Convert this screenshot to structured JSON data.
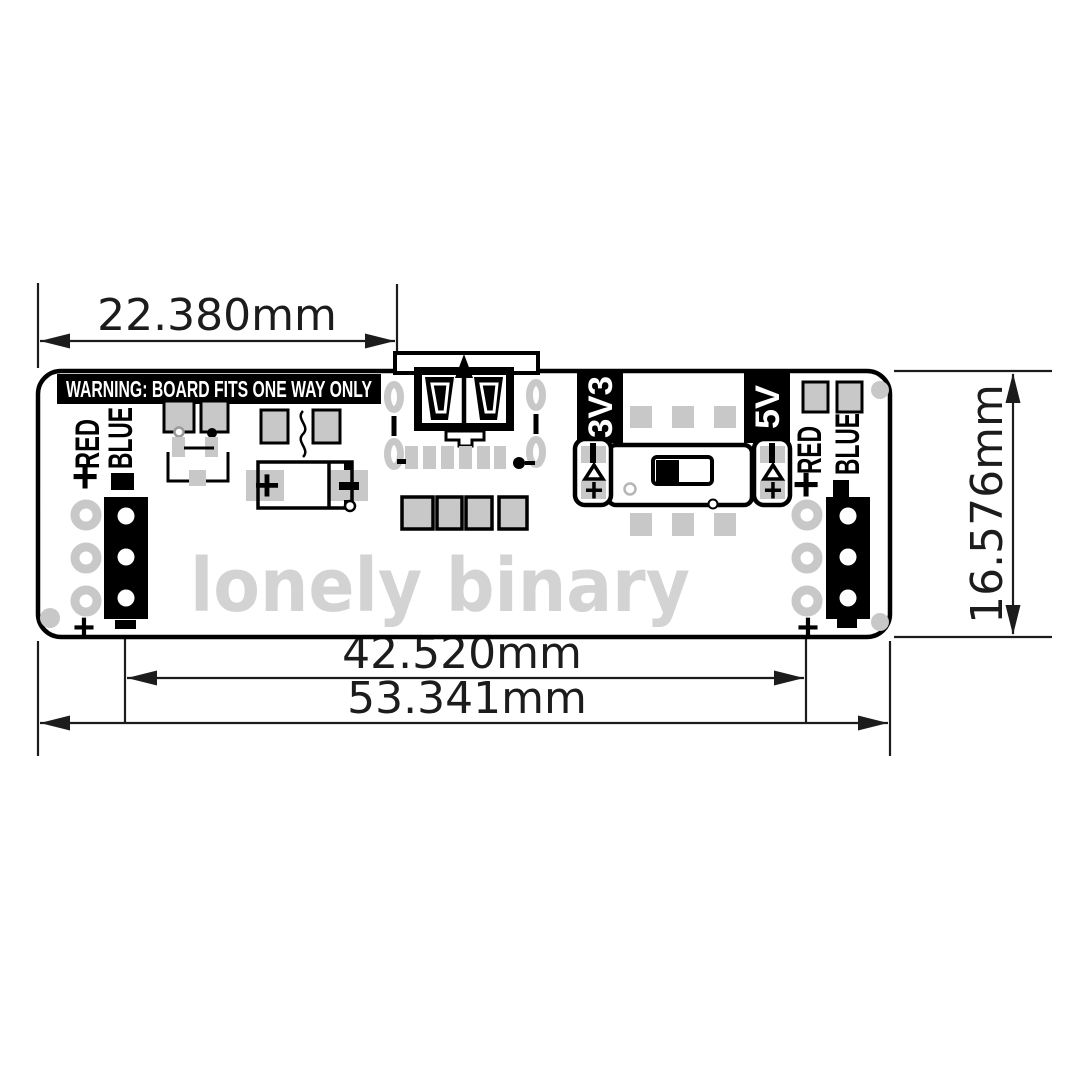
{
  "drawing": {
    "dimensions": {
      "usb_offset": "22.380mm",
      "rail_spacing": "42.520mm",
      "board_width": "53.341mm",
      "board_height": "16.576mm"
    },
    "silkscreen": {
      "warning": "WARNING: BOARD FITS ONE WAY ONLY",
      "watermark": "lonely binary",
      "rail_red": "RED",
      "rail_blue": "BLUE",
      "voltage_3v3": "3V3",
      "voltage_5v": "5V",
      "plus": "+",
      "minus": "−"
    },
    "colors": {
      "pad_gray": "#c8c8c8",
      "silk_black": "#000000",
      "watermark_gray": "#d3d3d3",
      "background": "#ffffff"
    }
  }
}
